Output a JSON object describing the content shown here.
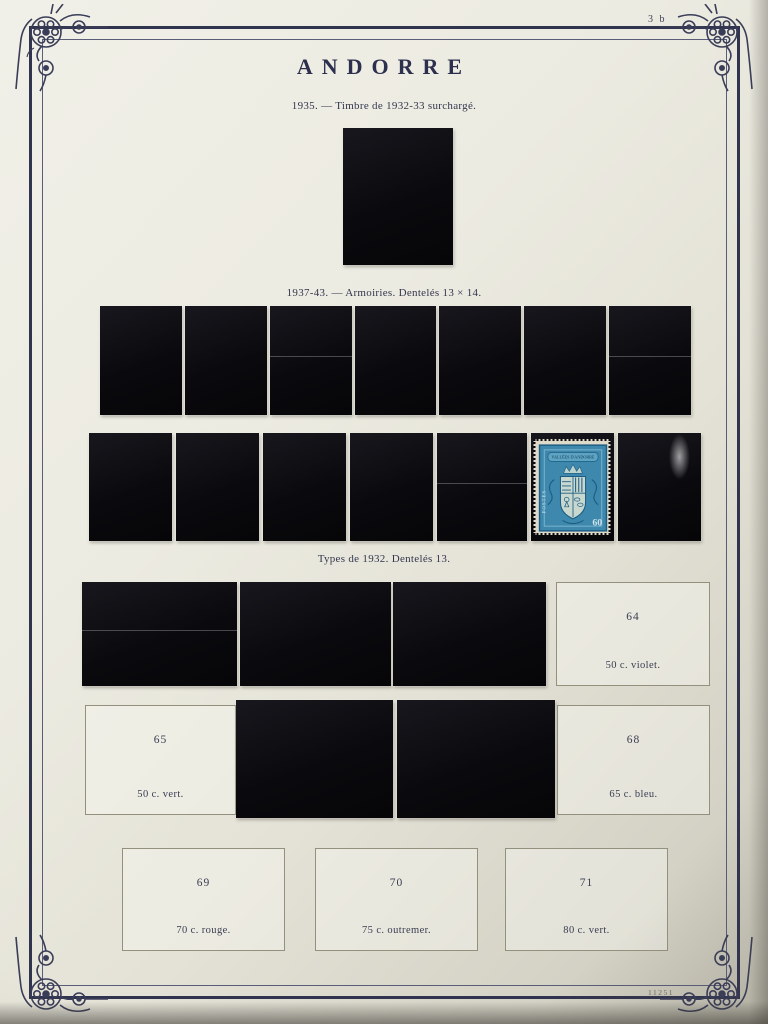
{
  "page": {
    "title": "ANDORRE",
    "page_number": "3 b",
    "plate_number": "11251"
  },
  "sections": {
    "surcharge_1935": {
      "caption": "1935. — Timbre de 1932-33 surchargé."
    },
    "armoiries_1937": {
      "caption": "1937-43. — Armoiries. Dentelés 13 × 14."
    },
    "types_1932": {
      "caption": "Types de 1932. Dentelés 13."
    }
  },
  "visible_stamp": {
    "banner": "VALLÉES D'ANDORRE",
    "value": "60",
    "side_label": "POSTES",
    "color": "#3e88ad"
  },
  "empty_frames": {
    "f64": {
      "number": "64",
      "caption": "50 c. violet."
    },
    "f65": {
      "number": "65",
      "caption": "50 c. vert."
    },
    "f68": {
      "number": "68",
      "caption": "65 c. bleu."
    },
    "f69": {
      "number": "69",
      "caption": "70 c. rouge."
    },
    "f70": {
      "number": "70",
      "caption": "75 c. outremer."
    },
    "f71": {
      "number": "71",
      "caption": "80 c. vert."
    }
  },
  "colors": {
    "ink": "#2e3150",
    "page": "#e9e7dd",
    "mount_black": "#0b0b0f",
    "stamp_blue": "#3e88ad"
  }
}
